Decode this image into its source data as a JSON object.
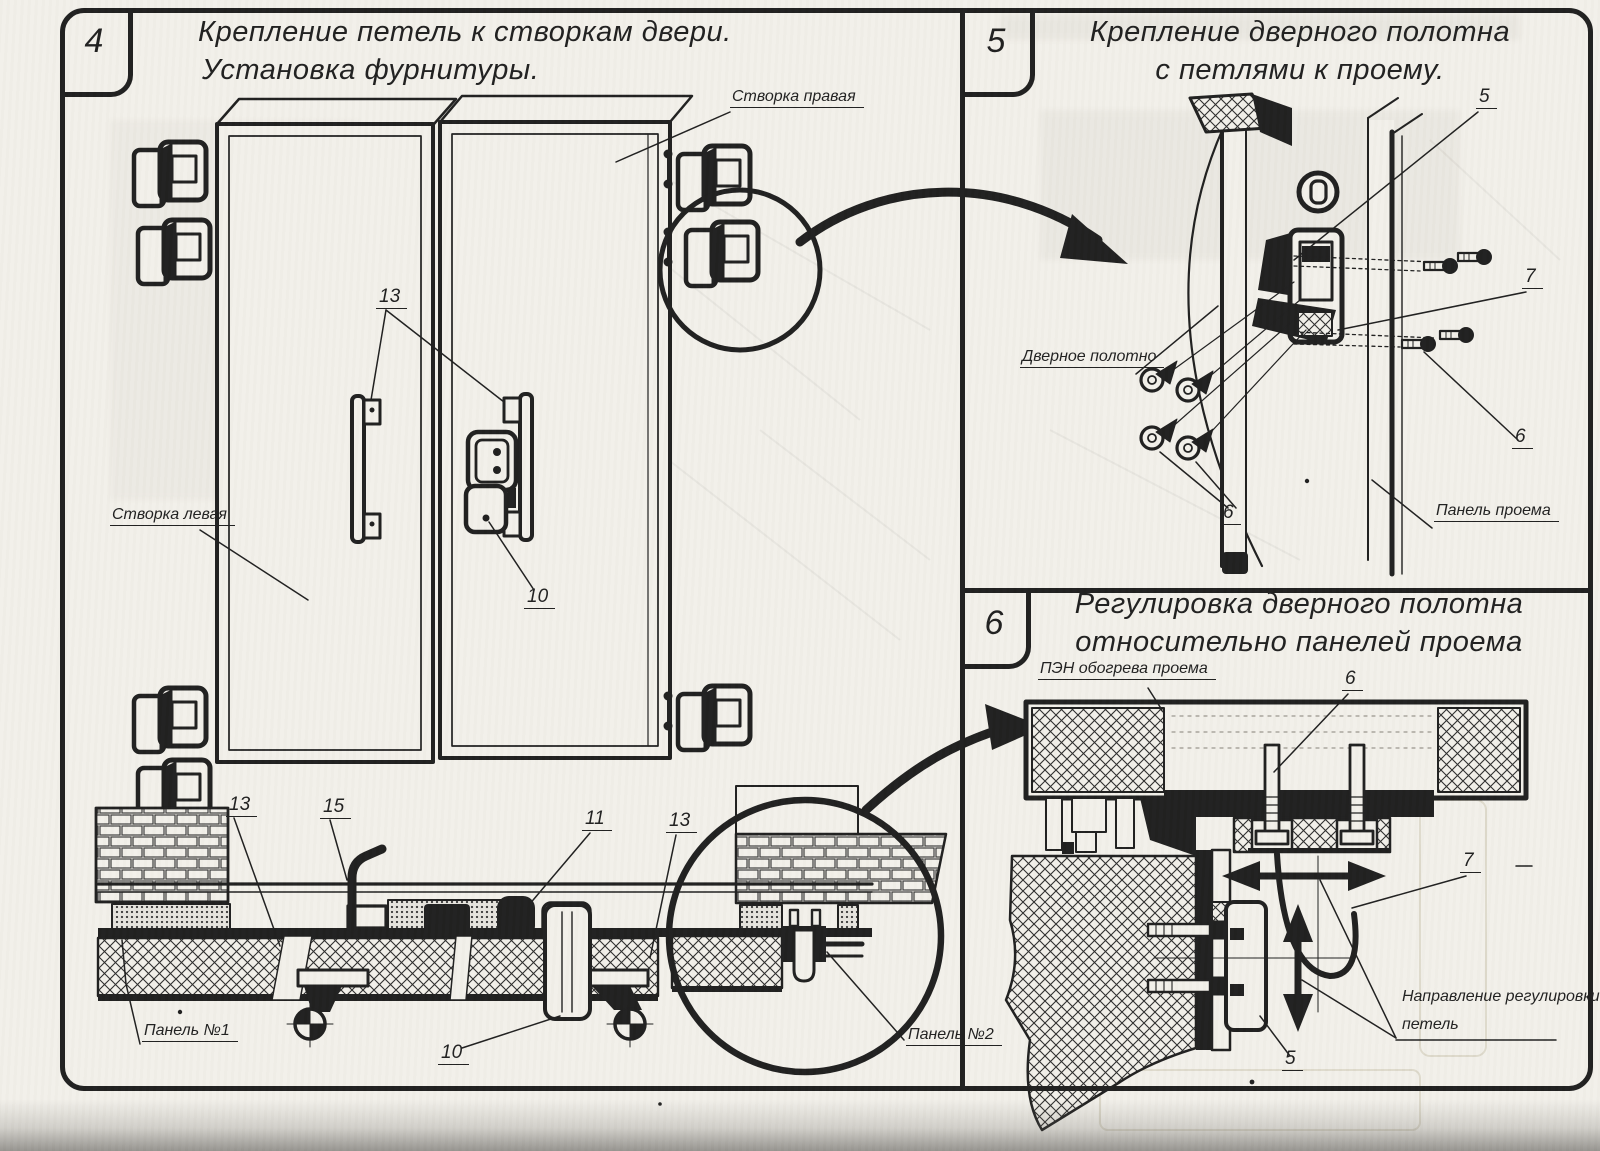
{
  "sheet": {
    "paper_color": "#f2f0ea",
    "ink_color": "#1f1f1f"
  },
  "panels": {
    "p4": {
      "number": "4",
      "title_line1": "Крепление петель к створкам двери.",
      "title_line2": "Установка фурнитуры.",
      "labels": {
        "right_leaf": "Створка правая",
        "left_leaf": "Створка левая",
        "panel1": "Панель №1",
        "panel2": "Панель №2"
      },
      "callouts": {
        "handles": "13",
        "latch": "10",
        "c13_left": "13",
        "c15": "15",
        "c11": "11",
        "c13_right": "13",
        "c10_bottom": "10"
      }
    },
    "p5": {
      "number": "5",
      "title_line1": "Крепление дверного полотна",
      "title_line2": "с петлями к проему.",
      "labels": {
        "door_leaf": "Дверное полотно",
        "panel_opening": "Панель проема"
      },
      "callouts": {
        "c5": "5",
        "c7": "7",
        "c6_right": "6",
        "c6_bottom": "6"
      }
    },
    "p6": {
      "number": "6",
      "title_line1": "Регулировка дверного полотна",
      "title_line2": "относительно панелей проема",
      "labels": {
        "heater": "ПЭН обогрева проема",
        "direction_line1": "Направление регулировки",
        "direction_line2": "петель"
      },
      "callouts": {
        "c6": "6",
        "c7": "7",
        "c5": "5"
      }
    }
  }
}
